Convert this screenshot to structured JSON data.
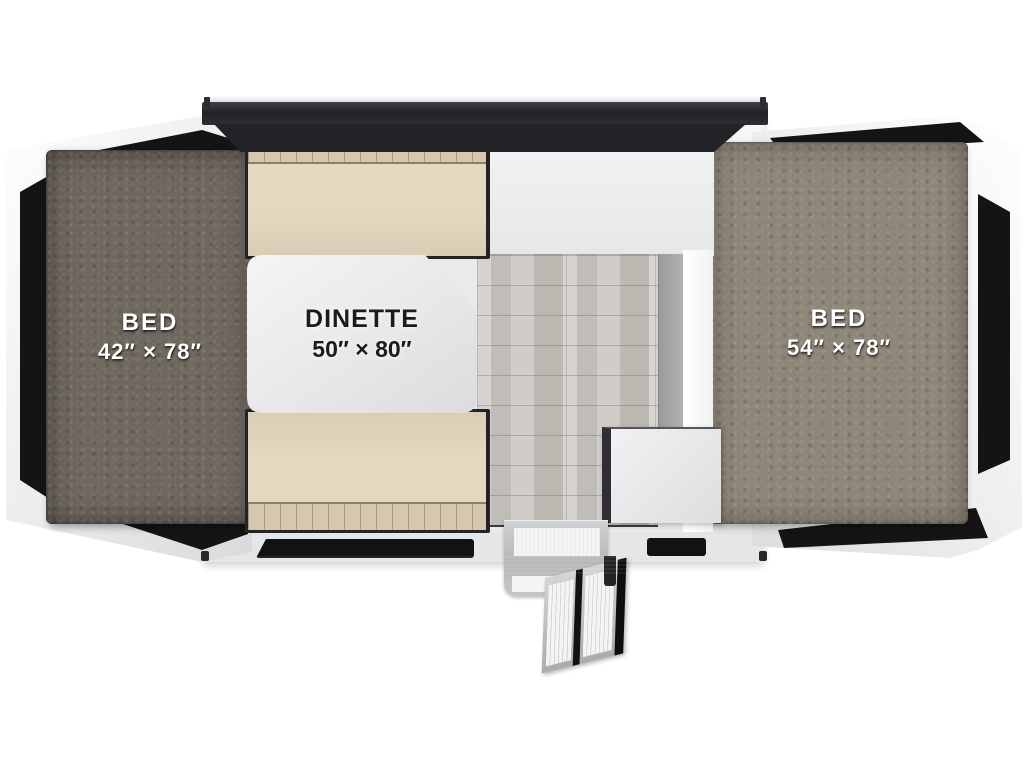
{
  "diagram": {
    "type": "rv-floorplan",
    "labels": {
      "bed_left": {
        "line1": "BED",
        "line2": "42″ × 78″"
      },
      "dinette": {
        "line1": "DINETTE",
        "line2": "50″ × 80″"
      },
      "bed_right": {
        "line1": "BED",
        "line2": "54″ × 78″"
      }
    },
    "colors": {
      "background": "#ffffff",
      "roof_bar": "#232327",
      "tent_fabric": "#141417",
      "mattress_left": "#6f685f",
      "mattress_right": "#8e8679",
      "cushion_beige": "#e0d4bc",
      "table_white": "#ececee",
      "floor_wood": "#c8c5c0",
      "bumper_rail": "#1b1b1e",
      "step_metal": "#bcbdbf",
      "label_text_light": "#ffffff",
      "label_text_dark": "#1b1b1d"
    }
  }
}
